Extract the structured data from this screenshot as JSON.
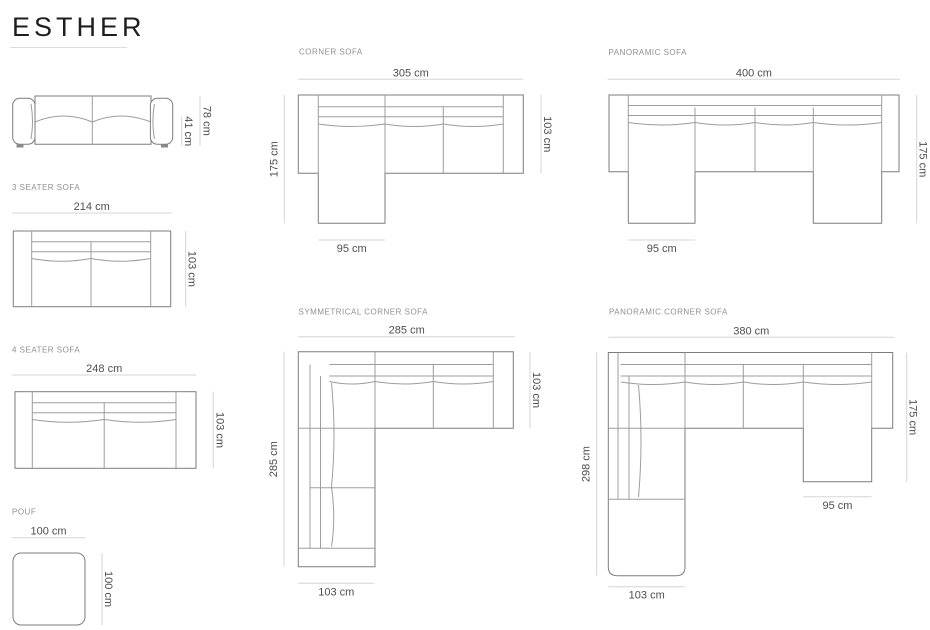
{
  "title": "ESTHER",
  "colors": {
    "background": "#ffffff",
    "title_text": "#1e1e1e",
    "outline_line": "#7d7d7d",
    "inner_line": "#9d9d9d",
    "dim_line": "#d5d5d5",
    "dim_text": "#4d4d4d",
    "section_label": "#8f8f8f"
  },
  "products": {
    "front_view": {
      "total_height": "78 cm",
      "seat_height": "41 cm"
    },
    "three_seater": {
      "label": "3 SEATER SOFA",
      "width": "214 cm",
      "depth": "103 cm"
    },
    "four_seater": {
      "label": "4 SEATER SOFA",
      "width": "248 cm",
      "depth": "103 cm"
    },
    "pouf": {
      "label": "POUF",
      "width": "100 cm",
      "depth": "100 cm"
    },
    "corner": {
      "label": "CORNER SOFA",
      "width": "305 cm",
      "depth": "103 cm",
      "total_depth": "175 cm",
      "chaise_width": "95 cm"
    },
    "panoramic": {
      "label": "PANORAMIC SOFA",
      "width": "400 cm",
      "total_depth": "175 cm",
      "chaise_width": "95 cm"
    },
    "symmetrical_corner": {
      "label": "SYMMETRICAL CORNER SOFA",
      "width": "285 cm",
      "depth": "103 cm",
      "left_length": "285 cm",
      "bottom_width": "103 cm"
    },
    "panoramic_corner": {
      "label": "PANORAMIC CORNER SOFA",
      "width": "380 cm",
      "total_depth": "175 cm",
      "left_length": "298 cm",
      "chaise_width": "95 cm",
      "bottom_width": "103 cm"
    }
  }
}
